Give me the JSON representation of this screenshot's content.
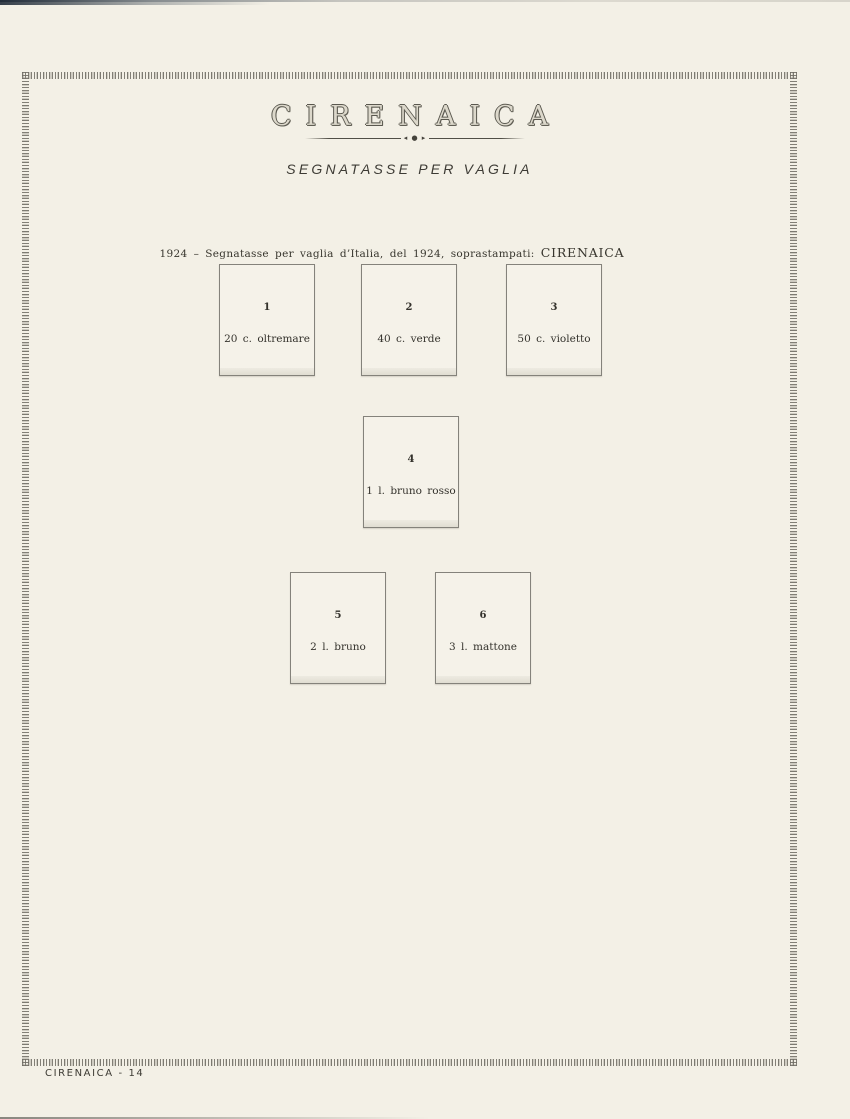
{
  "page": {
    "title": "CIRENAICA",
    "divider_ornament": "◂ ● ▸",
    "subtitle": "SEGNATASSE PER VAGLIA",
    "caption": {
      "text": "1924 – Segnatasse per vaglia d’Italia, del 1924, soprastampati:",
      "emphasis": "CIRENAICA"
    },
    "footer": "CIRENAICA - 14"
  },
  "stamps": [
    {
      "number": "1",
      "label": "20 c. oltremare"
    },
    {
      "number": "2",
      "label": "40 c. verde"
    },
    {
      "number": "3",
      "label": "50 c. violetto"
    },
    {
      "number": "4",
      "label": "1 l. bruno rosso"
    },
    {
      "number": "5",
      "label": "2 l. bruno"
    },
    {
      "number": "6",
      "label": "3 l. mattone"
    }
  ],
  "colors": {
    "paper": "#f3f0e6",
    "box_fill": "#f5f2e9",
    "box_border": "#84827b",
    "ink": "#34322c",
    "hatch_border": "#6e6b63",
    "scan_edge": "#16222e"
  }
}
